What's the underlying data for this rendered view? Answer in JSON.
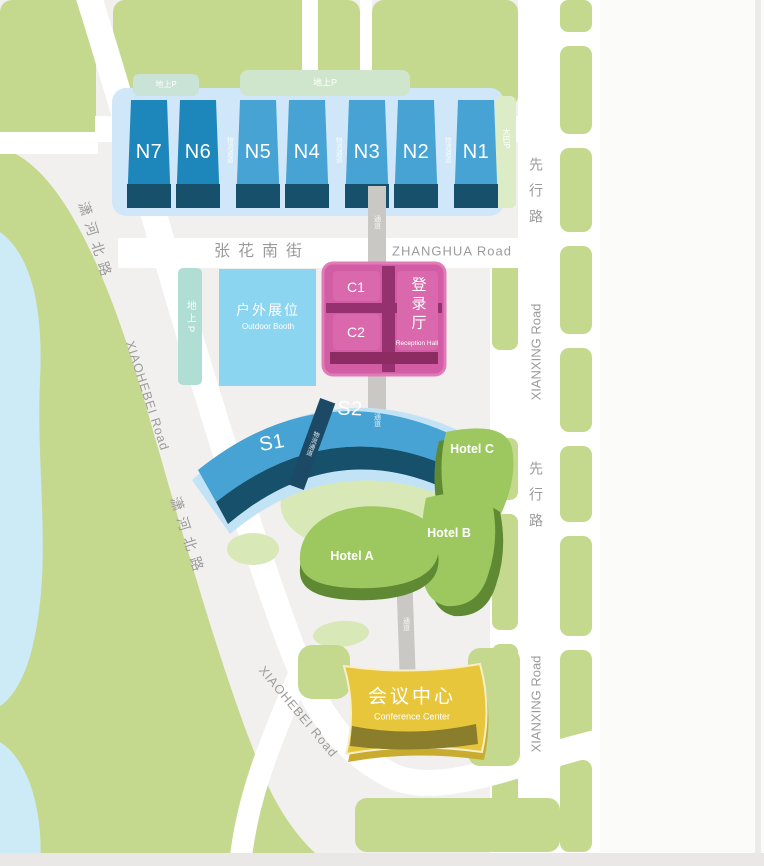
{
  "sidebar": {
    "compass_label": "N",
    "stats": [
      {
        "value": "100,000",
        "unit": "平方米",
        "zh": "室内面积",
        "en": "INDOOR EXHIBITION AREA"
      },
      {
        "value": "30,000",
        "unit": "平方米",
        "zh": "室外展览面积",
        "en": "OUTDOOR EXHIBITION AREA"
      },
      {
        "value": "9",
        "unit": "个",
        "zh": "重型展厅",
        "en": "HEAVY LOADING EXHIBITION HALLS"
      },
      {
        "value": "2",
        "unit": "个",
        "zh": "多功能展厅",
        "en": "MULTI-FUNCTIONAL EXHIBITION HALLS"
      },
      {
        "value": "10",
        "unit": "吨/平米",
        "zh": "地面荷载",
        "en": "LOADING"
      },
      {
        "value": "100",
        "unit": "个",
        "zh": "配套会议室",
        "en": "CONFERENCE ROOMS"
      },
      {
        "value": "3",
        "unit": "座",
        "lines": [
          "A 温德姆至尊",
          "WYNDHAMGRAND",
          "B 拉昆塔温德姆",
          "LA QUINTA BY WYNDHAM",
          "C 万达锦华",
          "WANDA JIN"
        ]
      },
      {
        "value": "1611",
        "unit": "间",
        "zh": "客房",
        "en": "GUEST ROOM"
      },
      {
        "value": "2030",
        "unit": "张",
        "zh": "床位",
        "en": "BEDS"
      },
      {
        "value": "3000",
        "unit": "个",
        "zh": "停车位",
        "en": "PARKING"
      }
    ]
  },
  "map": {
    "north_halls": [
      "N7",
      "N6",
      "N5",
      "N4",
      "N3",
      "N2",
      "N1"
    ],
    "south_halls": [
      "S1",
      "S2"
    ],
    "central_halls": [
      "C1",
      "C2"
    ],
    "reception_hall": {
      "zh": "登录厅",
      "en": "Reception Hall"
    },
    "outdoor_booth": {
      "zh": "户外展位",
      "en": "Outdoor Booth"
    },
    "conference_center": {
      "zh": "会议中心",
      "en": "Conference Center"
    },
    "hotels": [
      "Hotel A",
      "Hotel B",
      "Hotel C"
    ],
    "roads": {
      "zhanghua_zh": "张花南街",
      "zhanghua_en": "ZHANGHUA Road",
      "xianxing_zh": "先行路",
      "xianxing_en": "XIANXING Road",
      "xiaohebei_zh": "潇河北路",
      "xiaohebei_en": "XIAOHEBEI Road"
    },
    "annotations": {
      "ground_parking": "地上P",
      "bus_parking": "大巴P",
      "corridor": "通道",
      "logistics_corridor": "物流通道"
    },
    "colors": {
      "background": "#f1f0ee",
      "green": "#c5d98e",
      "pale_green": "#d8e8b6",
      "water": "#cdeaf7",
      "hall_blue": "#46a3d4",
      "hall_blue_dark": "#1d86ba",
      "hall_shadow": "#17506b",
      "baseplate": "#cfe7f8",
      "outdoor_blue": "#8bd5f1",
      "parking_teal": "#b0ded4",
      "pink": "#d35da4",
      "pink_dark": "#96316f",
      "hotel_green": "#9cc85f",
      "hotel_dark": "#5f8a33",
      "gold": "#e8c63c",
      "gold_dark": "#8a7d2c",
      "road_white": "#ffffff",
      "corridor_gray": "#c9c8c5",
      "road_text": "#9b9b9b",
      "stat_blue": "#7fc3d8"
    }
  }
}
